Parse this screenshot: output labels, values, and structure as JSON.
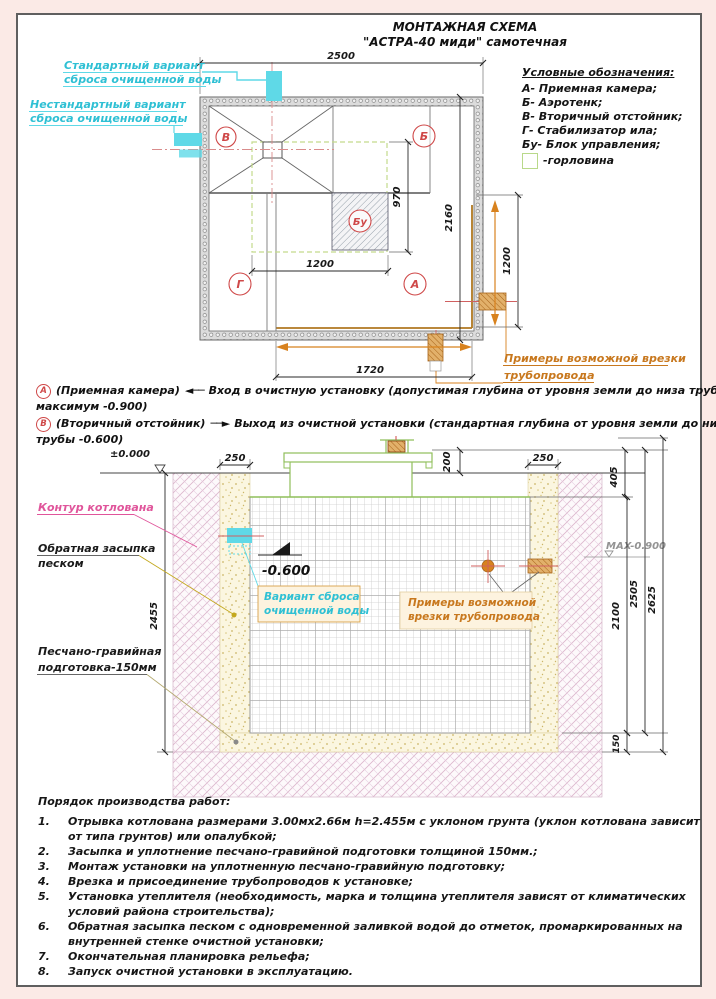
{
  "title": {
    "line1": "МОНТАЖНАЯ СХЕМА",
    "line2": "\"АСТРА-40 миди\" самотечная"
  },
  "legend": {
    "title": "Условные обозначения:",
    "items": [
      "А- Приемная камера;",
      "Б- Аэротенк;",
      "В- Вторичный отстойник;",
      "Г- Стабилизатор ила;",
      "Бу- Блок управления;"
    ],
    "gorlovina": "-горловина"
  },
  "plan": {
    "labels": {
      "standard": [
        "Стандартный вариант",
        "сброса очищенной воды"
      ],
      "nonstandard": [
        "Нестандартный вариант",
        "сброса очищенной воды"
      ],
      "vrezka": [
        "Примеры возможной врезки",
        "трубопровода"
      ]
    },
    "chambers": {
      "v": "В",
      "b": "Б",
      "g": "Г",
      "a": "А",
      "bu": "Бу"
    },
    "dims": {
      "d2500": "2500",
      "d970": "970",
      "d2160": "2160",
      "d1200bu": "1200",
      "d1720": "1720",
      "d1200r": "1200"
    }
  },
  "notes": {
    "a": {
      "badge": "А",
      "name": "(Приемная камера)",
      "arrow": "◄──",
      "text1": "Вход в очистную установку (допустимая глубина от уровня земли до низа трубы",
      "text2": "максимум -0.900)"
    },
    "b": {
      "badge": "В",
      "name": "(Вторичный отстойник)",
      "arrow": "──►",
      "text1": "Выход из очистной установки (стандартная глубина от уровня земли до низа",
      "text2": "трубы -0.600)"
    }
  },
  "section": {
    "levels": {
      "zero": "±0.000",
      "out": "-0.600",
      "max": "MAX-0.900"
    },
    "dims": {
      "d250l": "250",
      "d200": "200",
      "d250r": "250",
      "d405": "405",
      "d2455": "2455",
      "d2100": "2100",
      "d2505": "2505",
      "d2625": "2625",
      "d150": "150"
    },
    "labels": {
      "kontur": "Контур котлована",
      "zasypka": [
        "Обратная засыпка",
        "песком"
      ],
      "podgotovka": [
        "Песчано-гравийная",
        "подготовка-150мм"
      ],
      "variant": [
        "Вариант сброса",
        "очищенной воды"
      ],
      "vrezka": [
        "Примеры возможной",
        "врезки трубопровода"
      ]
    }
  },
  "worklist": {
    "title": "Порядок производства работ:",
    "items": [
      {
        "n": "1.",
        "l1": "Отрывка котлована размерами 3.00мх2.66м h=2.455м с уклоном грунта (уклон котлована зависит",
        "l2": "от типа грунтов) или опалубкой;"
      },
      {
        "n": "2.",
        "l1": "Засыпка и уплотнение песчано-гравийной подготовки толщиной 150мм.;"
      },
      {
        "n": "3.",
        "l1": "Монтаж установки на уплотненную песчано-гравийную подготовку;"
      },
      {
        "n": "4.",
        "l1": "Врезка и присоединение трубопроводов к установке;"
      },
      {
        "n": "5.",
        "l1": "Установка утеплителя (необходимость, марка и толщина утеплителя зависят от климатических",
        "l2": "условий района строительства);"
      },
      {
        "n": "6.",
        "l1": "Обратная засыпка песком с одновременной заливкой водой до отметок, промаркированных на",
        "l2": "внутренней стенке очистной установки;"
      },
      {
        "n": "7.",
        "l1": "Окончательная планировка рельефа;"
      },
      {
        "n": "8.",
        "l1": "Запуск очистной установки в эксплуатацию."
      }
    ]
  },
  "colors": {
    "cyan": "#2fc0d4",
    "orange": "#c8781e",
    "red": "#cf4848",
    "green": "#8fbf5a",
    "magenta": "#e0559b"
  }
}
